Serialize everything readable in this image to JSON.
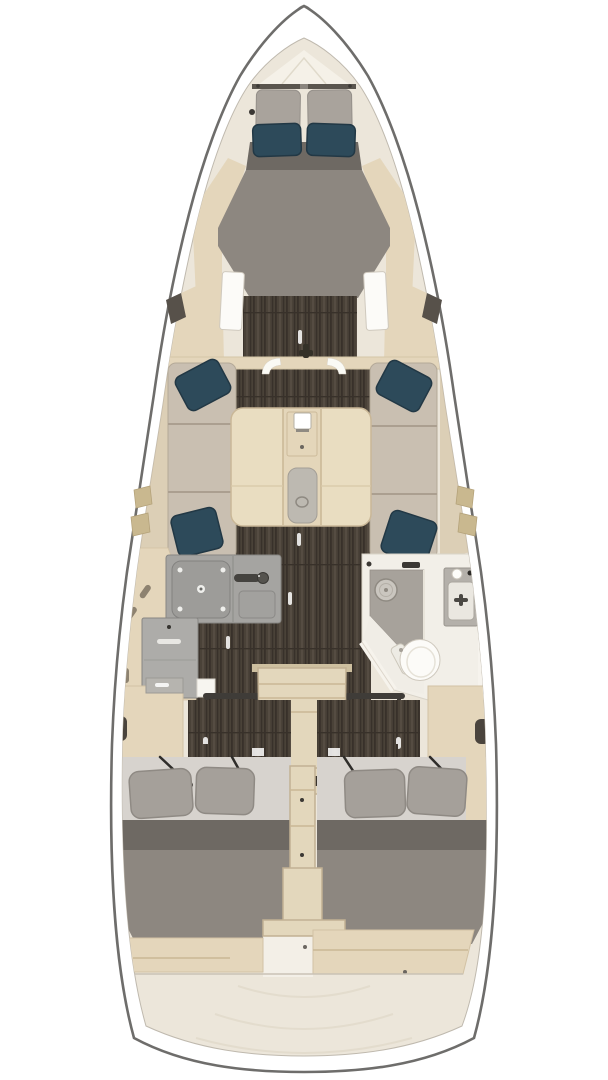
{
  "meta": {
    "image_type": "yacht-interior-floor-plan",
    "view": "top-down",
    "width_px": 608,
    "height_px": 1080
  },
  "regions": {
    "bow": {
      "name": "anchor-locker"
    },
    "forward_cabin": {
      "name": "v-berth-double",
      "teal_pillows": 2,
      "headboard_cushions": 2
    },
    "saloon": {
      "name": "saloon",
      "settees": [
        "port-settee",
        "starboard-settee"
      ],
      "teal_pillows": 4,
      "table": "centerline-folding-table",
      "table_items": [
        "latch-box",
        "tray-insert"
      ]
    },
    "galley": {
      "name": "l-shaped-galley",
      "side": "port",
      "features": [
        "stove",
        "sink",
        "faucet",
        "lower-locker"
      ]
    },
    "head": {
      "name": "wet-head",
      "side": "starboard",
      "features": [
        "shower-tray",
        "drain",
        "toilet",
        "washbasin",
        "vanity"
      ]
    },
    "companionway": {
      "name": "companionway-steps",
      "grab_rails": 2
    },
    "aft_cabin_port": {
      "name": "aft-double-berth-port",
      "gray_pillows": 2,
      "lid_stays": 2
    },
    "aft_cabin_starboard": {
      "name": "aft-double-berth-starboard",
      "gray_pillows": 2,
      "lid_stays": 2
    },
    "stern": {
      "name": "transom-deck"
    }
  },
  "colors": {
    "hull_stroke": "#6e6d6b",
    "bow_cap": "#8c8c8c",
    "deck_white": "#ffffff",
    "inner_edge": "#bfb9ae",
    "interior_cream": "#ece6da",
    "locker_cream": "#f5f1e8",
    "wood_light": "#e4d6bb",
    "wood_mid": "#d5c4a6",
    "table_wood": "#e9ddc1",
    "stair_wood": "#e3d7bc",
    "floor_dark": "#4a4238",
    "plank_dark": "#38312a",
    "plank_light": "#5c5348",
    "cushion_beige": "#c9bfb1",
    "cushion_seam": "#ab9f90",
    "pillow_teal": "#2d4a5a",
    "pillow_teal_dark": "#223845",
    "headboard_gray": "#a9a39c",
    "mattress_gray": "#8d8780",
    "mattress_dark": "#6e6963",
    "sheet_light": "#d7d3ce",
    "pillow_gray": "#a5a09a",
    "pillow_gray_edge": "#8f8a84",
    "counter_gray": "#a5a4a1",
    "counter_edge": "#878683",
    "cabinet_gray": "#adaca9",
    "head_white": "#f2efe8",
    "head_edge": "#d9d4c9",
    "shower_gray": "#a7a29b",
    "fixture_white": "#fcfbf8",
    "fixture_edge": "#cfc9be",
    "hardware_dark": "#3b3834",
    "window_tan": "#c9b88f",
    "window_dark": "#57514a",
    "strut_dark": "#2f2d2a",
    "transom_line": "#e3dccd"
  }
}
